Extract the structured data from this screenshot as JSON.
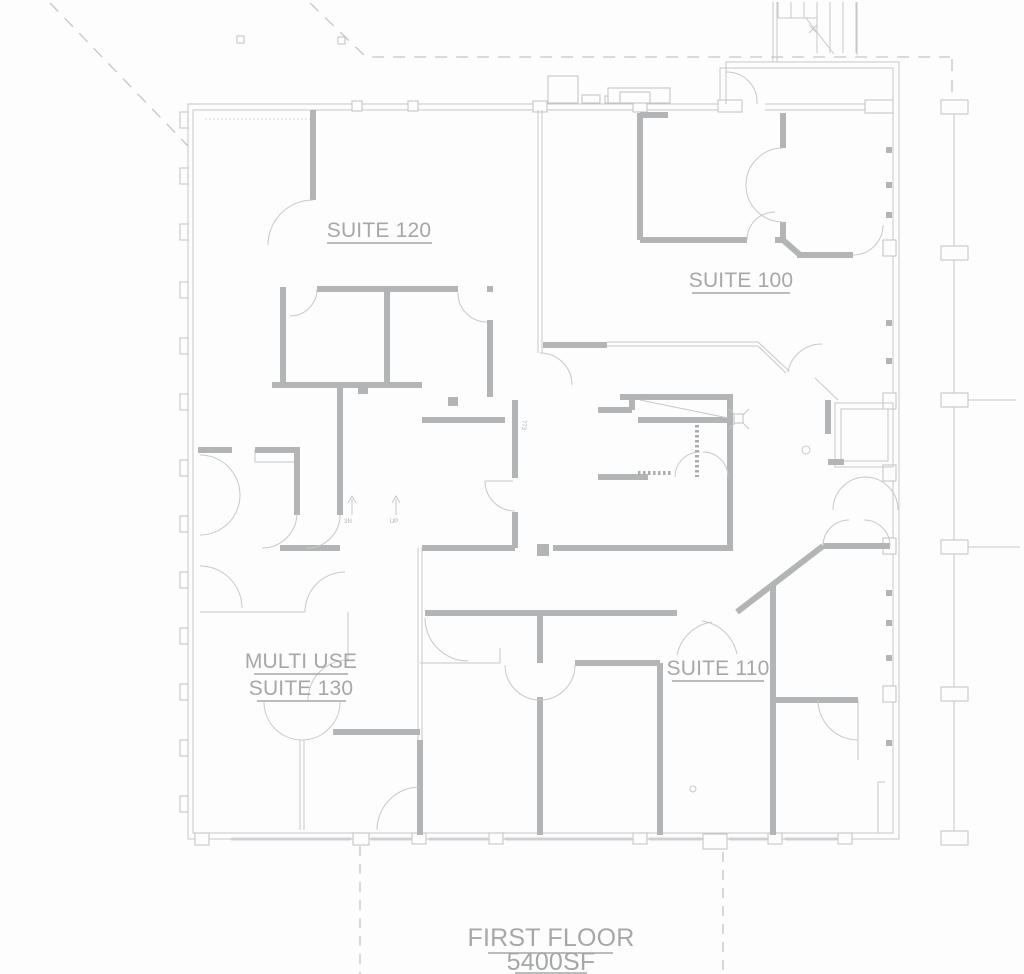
{
  "drawing": {
    "title_line1": "FIRST FLOOR",
    "title_line2": "5400SF",
    "rooms": {
      "suite_120": "SUITE 120",
      "suite_100": "SUITE 100",
      "multi_use_line1": "MULTI USE",
      "multi_use_line2": "SUITE 130",
      "suite_110": "SUITE 110"
    },
    "annotations": {
      "corridor_tag": "773",
      "arrow_left_tag": "3N",
      "arrow_right_tag": "UP"
    },
    "colors": {
      "background": "#fdfdfd",
      "thick_wall": "#b2b4b6",
      "thin_line": "#c6c8ca",
      "dashed_line": "#c3c5c7",
      "label_text": "#a5a7a9"
    }
  }
}
